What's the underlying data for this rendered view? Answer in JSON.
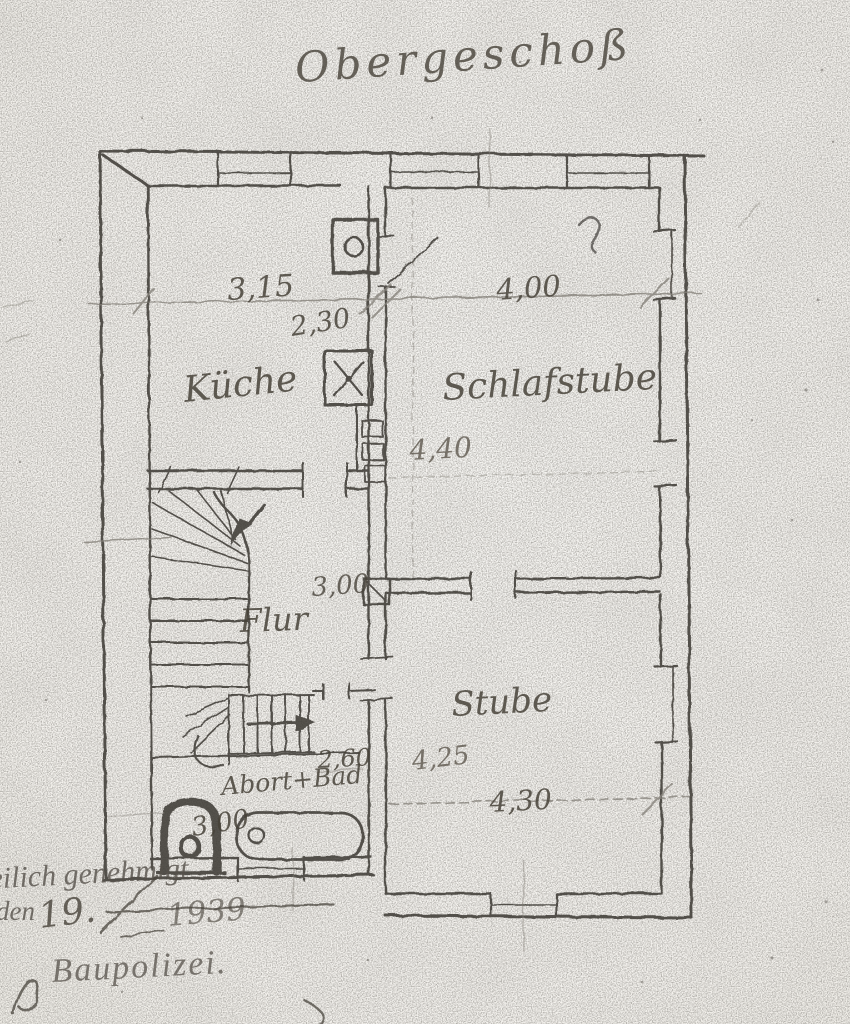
{
  "page": {
    "kind": "scanned hand-drawn floor plan",
    "paper_color": "#f6f5f1",
    "ink_color": "#3b3733",
    "pencil_color": "#85817a"
  },
  "plan": {
    "title": "Obergeschoß",
    "rooms": [
      {
        "id": "kueche",
        "label": "Küche"
      },
      {
        "id": "schlafstube",
        "label": "Schlafstube"
      },
      {
        "id": "flur",
        "label": "Flur"
      },
      {
        "id": "stube",
        "label": "Stube"
      },
      {
        "id": "abort-bad",
        "label": "Abort+Bad"
      }
    ],
    "dims": [
      {
        "id": "kueche-width",
        "text": "3,15"
      },
      {
        "id": "kueche-rest",
        "text": "2,30"
      },
      {
        "id": "schlafstube-width",
        "text": "4,00"
      },
      {
        "id": "schlafstube-depth",
        "text": "4,40"
      },
      {
        "id": "flur-width",
        "text": "3,00"
      },
      {
        "id": "stube-depth",
        "text": "4,25"
      },
      {
        "id": "stube-width",
        "text": "4,30"
      },
      {
        "id": "stair-bad-width",
        "text": "2,60"
      },
      {
        "id": "bad-width",
        "text": "3,00"
      }
    ],
    "approval": {
      "line1": "eilich genehmigt",
      "date_word": "den",
      "date_number": "19.",
      "date_year": "1939",
      "authority": "Baupolizei."
    }
  }
}
